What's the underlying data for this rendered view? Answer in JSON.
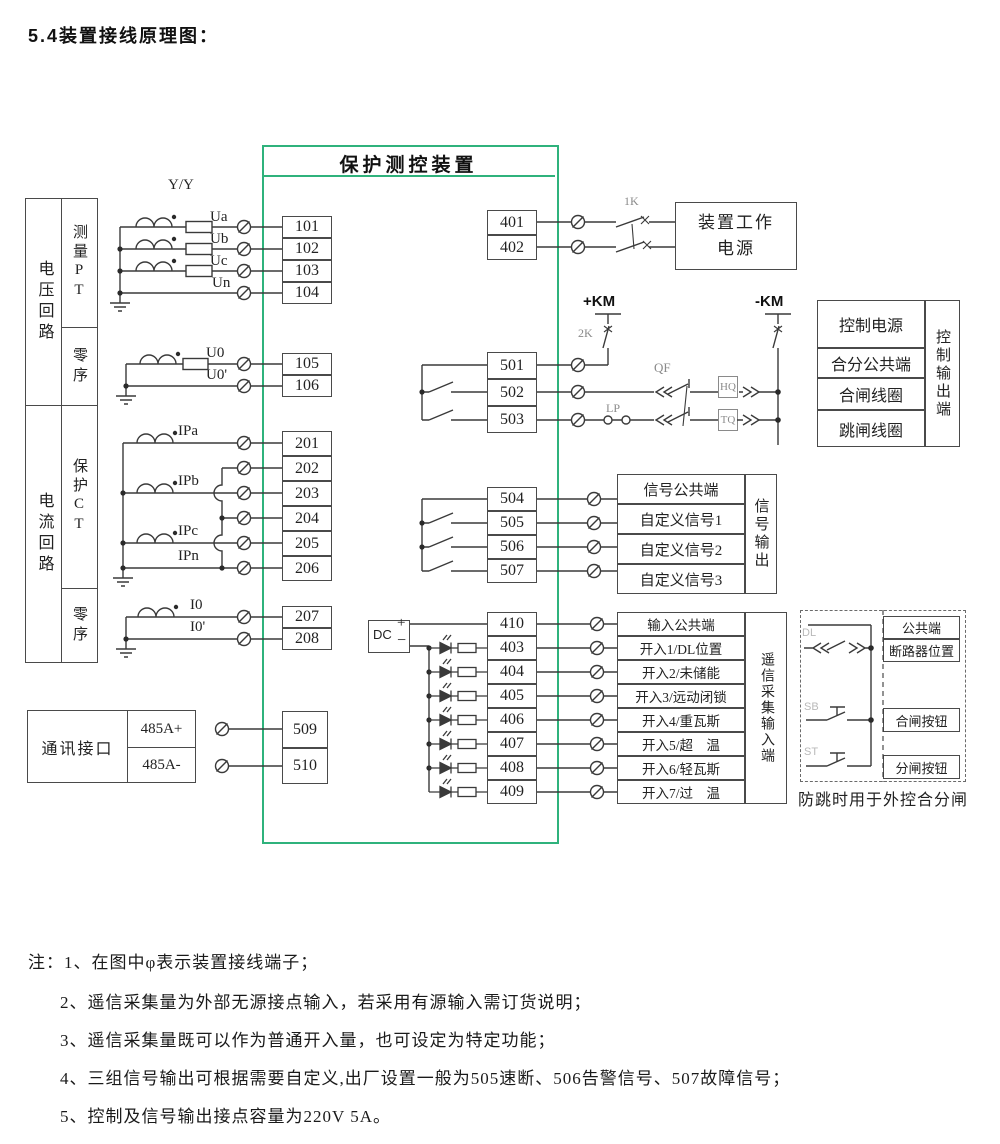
{
  "title": "5.4装置接线原理图：",
  "device": {
    "title": "保护测控装置"
  },
  "left_panel": {
    "voltage_group": "电压回路",
    "voltage_rows": [
      "测量PT",
      "零序"
    ],
    "current_group": "电流回路",
    "current_rows": [
      "保护CT",
      "零序"
    ]
  },
  "comm": {
    "label": "通讯接口",
    "ports": [
      "485A+",
      "485A-"
    ]
  },
  "terminals": {
    "voltage_measure": [
      "101",
      "102",
      "103",
      "104"
    ],
    "voltage_zero": [
      "105",
      "106"
    ],
    "current_protect": [
      "201",
      "202",
      "203",
      "204",
      "205",
      "206"
    ],
    "current_zero": [
      "207",
      "208"
    ],
    "comm": [
      "509",
      "510"
    ],
    "power": [
      "401",
      "402"
    ],
    "control": [
      "501",
      "502",
      "503"
    ],
    "signal": [
      "504",
      "505",
      "506",
      "507"
    ],
    "input": [
      "410",
      "403",
      "404",
      "405",
      "406",
      "407",
      "408",
      "409"
    ]
  },
  "power_box": {
    "label": "装置工作\n电源"
  },
  "control_out": {
    "rows": [
      "控制电源",
      "合分公共端",
      "合闸线圈",
      "跳闸线圈"
    ],
    "side": "控制输出端"
  },
  "signal_out": {
    "rows": [
      "信号公共端",
      "自定义信号1",
      "自定义信号2",
      "自定义信号3"
    ],
    "side": "信号输出"
  },
  "remote_in": {
    "rows": [
      "输入公共端",
      "开入1/DL位置",
      "开入2/未储能",
      "开入3/远动闭锁",
      "开入4/重瓦斯",
      "开入5/超　温",
      "开入6/轻瓦斯",
      "开入7/过　温"
    ],
    "side": "遥信采集输入端"
  },
  "external_box": {
    "cells": [
      "公共端",
      "断路器位置",
      "合闸按钮",
      "分闸按钮"
    ],
    "caption": "防跳时用于外控合分闸"
  },
  "wire_labels": {
    "pt_ratio": "Y/Y",
    "ua": "Ua",
    "ub": "Ub",
    "uc": "Uc",
    "un": "Un",
    "u0": "U0",
    "u0p": "U0'",
    "ipa": "IPa",
    "ipb": "IPb",
    "ipc": "IPc",
    "ipn": "IPn",
    "i0": "I0",
    "i0p": "I0'",
    "k1": "1K",
    "k2": "2K",
    "qf": "QF",
    "lp": "LP",
    "hq": "HQ",
    "tq": "TQ",
    "km_plus": "+KM",
    "km_minus": "-KM",
    "dc": "DC",
    "plus": "+",
    "minus": "−",
    "dl": "DL",
    "sb": "SB",
    "st": "ST"
  },
  "notes": [
    "注：1、在图中φ表示装置接线端子；",
    "2、遥信采集量为外部无源接点输入，若采用有源输入需订货说明；",
    "3、遥信采集量既可以作为普通开入量，也可设定为特定功能；",
    "4、三组信号输出可根据需要自定义,出厂设置一般为505速断、506告警信号、507故障信号；",
    "5、控制及信号输出接点容量为220V 5A。"
  ],
  "colors": {
    "accent_green": "#2fb27c",
    "line": "#3a3a3a",
    "gray_label": "#8a8a8a"
  }
}
